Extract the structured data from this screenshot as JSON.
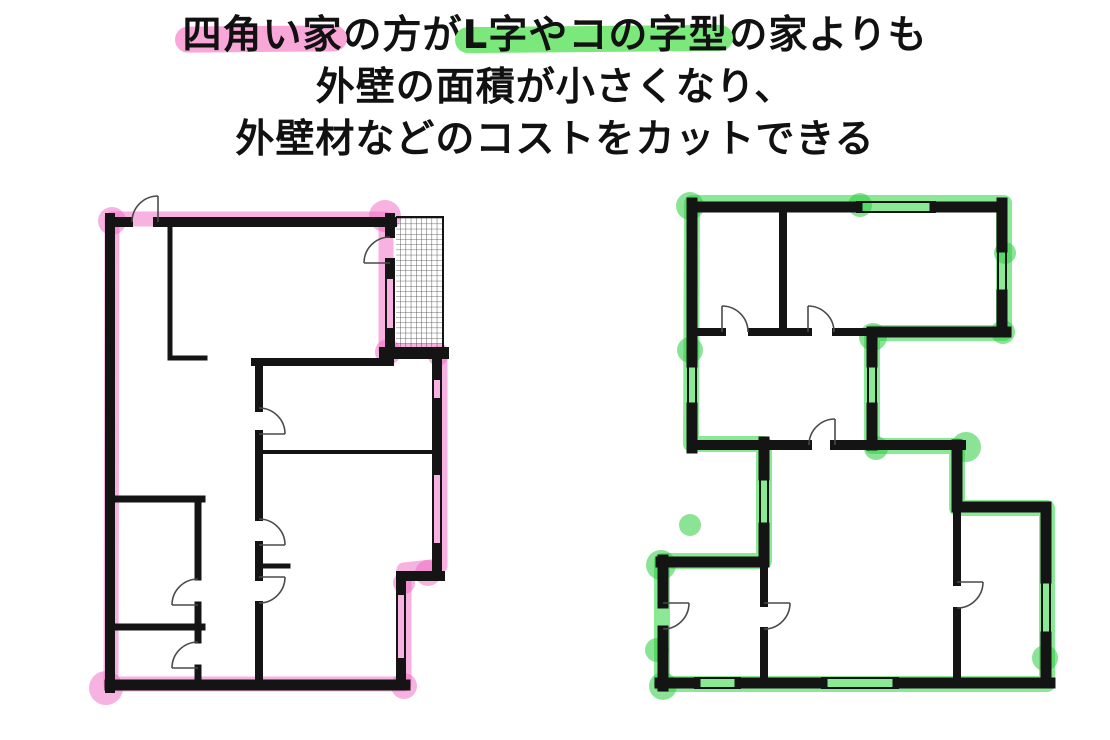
{
  "title": {
    "line1_seg1": "四角い家",
    "line1_seg2": "の方が",
    "line1_seg3": "L字やコの字型",
    "line1_seg4": "の家よりも",
    "line2": "外壁の面積が小さくなり、",
    "line3": "外壁材などのコストをカットできる"
  },
  "colors": {
    "pink_text_highlight": "#F9A6D8",
    "green_text_highlight": "#7BE87B",
    "pink_marker": "rgba(242,122,203,0.58)",
    "pink_blob": "rgba(238,104,195,0.50)",
    "green_marker": "rgba(60,218,78,0.60)",
    "green_blob": "rgba(44,204,64,0.55)",
    "wall": "#141414",
    "door_arc": "#4a4a4a"
  },
  "figure": {
    "left_plan_meaning": "四角い家",
    "right_plan_meaning": "L字やコの字型の家"
  }
}
